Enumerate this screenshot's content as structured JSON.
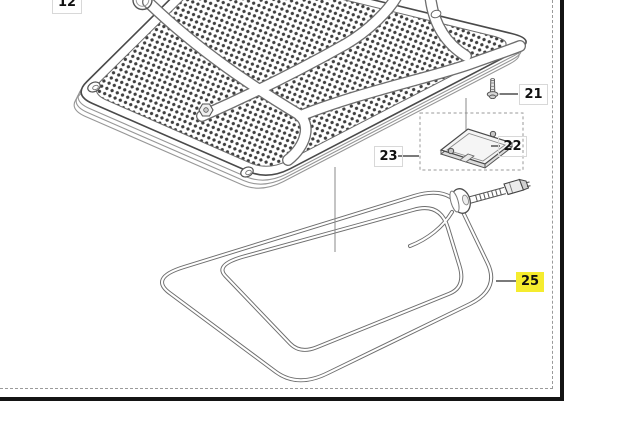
{
  "diagram": {
    "highlight_color": "#f5ec2e",
    "line_color": "#4a4a4a",
    "background": "#ffffff",
    "callouts": [
      {
        "id": "12",
        "label": "12",
        "highlighted": false
      },
      {
        "id": "21",
        "label": "21",
        "highlighted": false
      },
      {
        "id": "22",
        "label": "22",
        "highlighted": false
      },
      {
        "id": "23",
        "label": "23",
        "highlighted": false
      },
      {
        "id": "25",
        "label": "25",
        "highlighted": true
      }
    ]
  }
}
